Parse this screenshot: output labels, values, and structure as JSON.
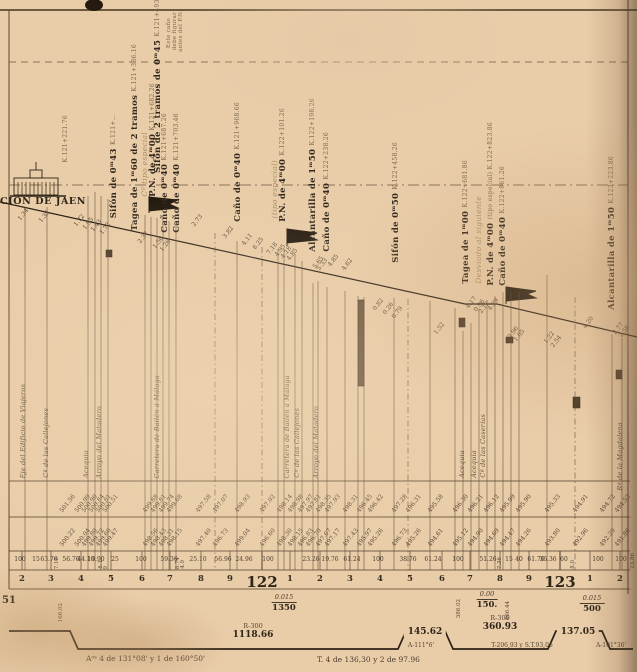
{
  "station": {
    "name": "CIÓN DE JAEN",
    "axis_km": "K.121+221.76"
  },
  "structures": [
    {
      "main": "",
      "km": "K.121+221.76",
      "x": 62,
      "b": 162
    },
    {
      "main": "Sifón de 0ᵐ43",
      "km": "K.121+…",
      "x": 110,
      "b": 218
    },
    {
      "main": "Tagea de 1ᵐ60 de 2 tramos",
      "km": "K.121+336.16",
      "x": 131,
      "b": 231
    },
    {
      "main": "Sifón de 2 tramos de 0ᵐ45",
      "km": "K.121+493.86",
      "x": 154,
      "b": 173
    },
    {
      "main": "Cº tipo especial",
      "x": 141,
      "b": 197,
      "style": "faint"
    },
    {
      "main": "P.N. de 4ᵐ00",
      "km": "K.121+682.26",
      "x": 149,
      "b": 197
    },
    {
      "main": "Caño de 0ᵐ40",
      "km": "K.121+687.26",
      "x": 161,
      "b": 233
    },
    {
      "main": "Caño de 0ᵐ40",
      "km": "K.121+703.46",
      "x": 173,
      "b": 233
    },
    {
      "main": "Este caño",
      "x": 165,
      "b": 48,
      "style": "tiny"
    },
    {
      "main": "debe figurar",
      "x": 171,
      "b": 50,
      "style": "tiny"
    },
    {
      "main": "antes del P.N.",
      "x": 177,
      "b": 52,
      "style": "tiny"
    },
    {
      "main": "Caño de 0ᵐ40",
      "km": "K.121+968.66",
      "x": 234,
      "b": 222
    },
    {
      "main": "(tipo especial)",
      "x": 271,
      "b": 218,
      "style": "faint"
    },
    {
      "main": "P.N. de 4ᵐ00",
      "km": "K.122+101.26",
      "x": 279,
      "b": 222
    },
    {
      "main": "Alcantarilla de 1ᵐ50",
      "km": "K.122+198.26",
      "x": 309,
      "b": 252
    },
    {
      "main": "Caño de 0ᵐ40",
      "km": "K.122+238.26",
      "x": 323,
      "b": 252
    },
    {
      "main": "Sifón de 0ᵐ50",
      "km": "K.122+458.26",
      "x": 392,
      "b": 263
    },
    {
      "main": "Tagea de 1ᵐ00",
      "km": "K.122+681.86",
      "x": 462,
      "b": 284
    },
    {
      "main": "Desviado al siguiente",
      "x": 475,
      "b": 284,
      "style": "faint"
    },
    {
      "main": "P.N. de 4ᵐ00",
      "km": "(tipo especial) K.122+823.86",
      "x": 487,
      "b": 286
    },
    {
      "main": "Caño de 0ᵐ40",
      "km": "K.122+861.26",
      "x": 499,
      "b": 286
    },
    {
      "main": "Alcantarilla de 1ᵐ50",
      "km": "K.123+223.86",
      "x": 608,
      "b": 310
    }
  ],
  "features": [
    {
      "t": "Eje del Edificio de Viajeros",
      "x": 24,
      "b": 478
    },
    {
      "t": "Cª de las Callejones",
      "x": 47,
      "b": 478
    },
    {
      "t": "Acequia",
      "x": 87,
      "b": 478
    },
    {
      "t": "Arroyo del Matadero",
      "x": 100,
      "b": 478
    },
    {
      "t": "Carretera de Bailén á Málaga",
      "x": 158,
      "b": 478
    },
    {
      "t": "Carretera de Bailén á Málaga",
      "x": 288,
      "b": 478
    },
    {
      "t": "Cº de las Callejones",
      "x": 298,
      "b": 478
    },
    {
      "t": "Arroyo del Matadero",
      "x": 317,
      "b": 478
    },
    {
      "t": "Acequia",
      "x": 463,
      "b": 478
    },
    {
      "t": "Acequia",
      "x": 475,
      "b": 478
    },
    {
      "t": "Cª de las Caserías",
      "x": 484,
      "b": 478
    },
    {
      "t": "Rª de la Magdalena",
      "x": 621,
      "b": 490
    }
  ],
  "profile_heights": [
    {
      "v": "1.34",
      "x": 22,
      "y": 222
    },
    {
      "v": "1.35",
      "x": 43,
      "y": 224
    },
    {
      "v": "1.72",
      "x": 78,
      "y": 228
    },
    {
      "v": "1.95",
      "x": 87,
      "y": 231
    },
    {
      "v": "1.43",
      "x": 95,
      "y": 233
    },
    {
      "v": "1.72",
      "x": 104,
      "y": 236
    },
    {
      "v": "2.37",
      "x": 142,
      "y": 245
    },
    {
      "v": "1.56",
      "x": 157,
      "y": 250
    },
    {
      "v": "1.26",
      "x": 164,
      "y": 253
    },
    {
      "v": "2.73",
      "x": 196,
      "y": 228
    },
    {
      "v": "3.82",
      "x": 227,
      "y": 240
    },
    {
      "v": "4.11",
      "x": 246,
      "y": 247
    },
    {
      "v": "6.25",
      "x": 257,
      "y": 251
    },
    {
      "v": "7.18",
      "x": 271,
      "y": 256
    },
    {
      "v": "4.95",
      "x": 279,
      "y": 258
    },
    {
      "v": "4.18",
      "x": 285,
      "y": 260
    },
    {
      "v": "4.85",
      "x": 291,
      "y": 262
    },
    {
      "v": "5.65",
      "x": 317,
      "y": 270
    },
    {
      "v": "5.33",
      "x": 321,
      "y": 272
    },
    {
      "v": "4.85",
      "x": 332,
      "y": 268
    },
    {
      "v": "4.62",
      "x": 346,
      "y": 272
    },
    {
      "v": "0.82",
      "x": 377,
      "y": 312
    },
    {
      "v": "0.26",
      "x": 387,
      "y": 316
    },
    {
      "v": "0.79",
      "x": 396,
      "y": 320
    },
    {
      "v": "1.52",
      "x": 438,
      "y": 336
    },
    {
      "v": "4.17",
      "x": 470,
      "y": 310
    },
    {
      "v": "0.96",
      "x": 478,
      "y": 313
    },
    {
      "v": "2.12",
      "x": 483,
      "y": 315
    },
    {
      "v": "4.29",
      "x": 492,
      "y": 312
    },
    {
      "v": "2.96",
      "x": 512,
      "y": 340
    },
    {
      "v": "1.65",
      "x": 518,
      "y": 343
    },
    {
      "v": "1.22",
      "x": 548,
      "y": 345
    },
    {
      "v": "2.54",
      "x": 555,
      "y": 349
    },
    {
      "v": "4.20",
      "x": 587,
      "y": 330
    },
    {
      "v": "2.77",
      "x": 617,
      "y": 336
    },
    {
      "v": "2.58",
      "x": 623,
      "y": 339
    }
  ],
  "table": {
    "rasante_row": [
      {
        "v": "501.56",
        "x": 64
      },
      {
        "v": "500.99",
        "x": 79
      },
      {
        "v": "500.90",
        "x": 86
      },
      {
        "v": "500.84",
        "x": 93
      },
      {
        "v": "500.81",
        "x": 100
      },
      {
        "v": "500.51",
        "x": 107
      },
      {
        "v": "499.88",
        "x": 147
      },
      {
        "v": "499.81",
        "x": 155
      },
      {
        "v": "499.74",
        "x": 163
      },
      {
        "v": "499.68",
        "x": 171
      },
      {
        "v": "497.58",
        "x": 200
      },
      {
        "v": "497.07",
        "x": 217
      },
      {
        "v": "498.93",
        "x": 239
      },
      {
        "v": "497.02",
        "x": 264
      },
      {
        "v": "498.14",
        "x": 281
      },
      {
        "v": "498.98",
        "x": 292
      },
      {
        "v": "497.97",
        "x": 302
      },
      {
        "v": "497.81",
        "x": 310
      },
      {
        "v": "498.35",
        "x": 320
      },
      {
        "v": "497.93",
        "x": 329
      },
      {
        "v": "498.31",
        "x": 347
      },
      {
        "v": "496.45",
        "x": 361
      },
      {
        "v": "496.42",
        "x": 372
      },
      {
        "v": "497.28",
        "x": 396
      },
      {
        "v": "496.31",
        "x": 410
      },
      {
        "v": "495.58",
        "x": 432
      },
      {
        "v": "496.30",
        "x": 457
      },
      {
        "v": "496.21",
        "x": 472
      },
      {
        "v": "496.12",
        "x": 488
      },
      {
        "v": "495.99",
        "x": 504
      },
      {
        "v": "495.90",
        "x": 520
      },
      {
        "v": "495.33",
        "x": 549
      },
      {
        "v": "494.91",
        "x": 577
      },
      {
        "v": "494.72",
        "x": 604
      },
      {
        "v": "494.52",
        "x": 619
      }
    ],
    "terreno_row": [
      {
        "v": "500.22",
        "x": 64
      },
      {
        "v": "500.04",
        "x": 79
      },
      {
        "v": "499.80",
        "x": 86
      },
      {
        "v": "499.72",
        "x": 93
      },
      {
        "v": "499.60",
        "x": 100
      },
      {
        "v": "499.47",
        "x": 107
      },
      {
        "v": "498.56",
        "x": 147
      },
      {
        "v": "498.43",
        "x": 155
      },
      {
        "v": "498.31",
        "x": 163
      },
      {
        "v": "498.15",
        "x": 171
      },
      {
        "v": "497.40",
        "x": 200
      },
      {
        "v": "496.73",
        "x": 217
      },
      {
        "v": "499.04",
        "x": 239
      },
      {
        "v": "496.60",
        "x": 264
      },
      {
        "v": "498.30",
        "x": 281
      },
      {
        "v": "498.15",
        "x": 292
      },
      {
        "v": "496.83",
        "x": 302
      },
      {
        "v": "496.70",
        "x": 310
      },
      {
        "v": "497.67",
        "x": 320
      },
      {
        "v": "497.17",
        "x": 329
      },
      {
        "v": "497.43",
        "x": 347
      },
      {
        "v": "495.97",
        "x": 361
      },
      {
        "v": "495.26",
        "x": 372
      },
      {
        "v": "496.73",
        "x": 396
      },
      {
        "v": "495.26",
        "x": 410
      },
      {
        "v": "494.61",
        "x": 432
      },
      {
        "v": "495.12",
        "x": 457
      },
      {
        "v": "494.90",
        "x": 472
      },
      {
        "v": "494.69",
        "x": 488
      },
      {
        "v": "494.47",
        "x": 504
      },
      {
        "v": "494.26",
        "x": 520
      },
      {
        "v": "493.80",
        "x": 549
      },
      {
        "v": "492.96",
        "x": 577
      },
      {
        "v": "492.20",
        "x": 604
      },
      {
        "v": "491.86",
        "x": 619
      }
    ],
    "distances_row": [
      {
        "v": "100",
        "x": 20
      },
      {
        "v": "15",
        "x": 36
      },
      {
        "v": "63.76",
        "x": 49
      },
      {
        "v": "7.18",
        "x": 58,
        "vert": 1
      },
      {
        "v": "56.76",
        "x": 71
      },
      {
        "v": "44.10",
        "x": 86
      },
      {
        "v": "19.90",
        "x": 96
      },
      {
        "v": "8.1",
        "x": 102,
        "vert": 1
      },
      {
        "v": "9",
        "x": 107,
        "vert": 1
      },
      {
        "v": "25",
        "x": 115
      },
      {
        "v": "100",
        "x": 141
      },
      {
        "v": "59.36",
        "x": 169
      },
      {
        "v": "8.74",
        "x": 179,
        "vert": 1
      },
      {
        "v": "4.9",
        "x": 184,
        "vert": 1
      },
      {
        "v": "25.10",
        "x": 198
      },
      {
        "v": "56.96",
        "x": 223
      },
      {
        "v": "24.96",
        "x": 244
      },
      {
        "v": "100",
        "x": 268
      },
      {
        "v": "23.26",
        "x": 311
      },
      {
        "v": "19.76",
        "x": 330
      },
      {
        "v": "61.24",
        "x": 352
      },
      {
        "v": "100",
        "x": 378
      },
      {
        "v": "38.76",
        "x": 408
      },
      {
        "v": "61.24",
        "x": 433
      },
      {
        "v": "100",
        "x": 458
      },
      {
        "v": "51.26",
        "x": 488
      },
      {
        "v": "7.36",
        "x": 501,
        "vert": 1
      },
      {
        "v": "15",
        "x": 509
      },
      {
        "v": "40",
        "x": 519
      },
      {
        "v": "61.76",
        "x": 536
      },
      {
        "v": "36.36",
        "x": 548
      },
      {
        "v": "60",
        "x": 564
      },
      {
        "v": "8.0",
        "x": 574,
        "vert": 1
      },
      {
        "v": "100",
        "x": 598
      },
      {
        "v": "100",
        "x": 621
      },
      {
        "v": "23.86",
        "x": 634,
        "vert": 1
      }
    ]
  },
  "hectometers": [
    {
      "n": "2",
      "x": 22
    },
    {
      "n": "3",
      "x": 51
    },
    {
      "n": "4",
      "x": 81
    },
    {
      "n": "5",
      "x": 111
    },
    {
      "n": "6",
      "x": 142
    },
    {
      "n": "7",
      "x": 170
    },
    {
      "n": "8",
      "x": 201
    },
    {
      "n": "9",
      "x": 230
    },
    {
      "n": "1",
      "x": 290
    },
    {
      "n": "2",
      "x": 320
    },
    {
      "n": "3",
      "x": 350
    },
    {
      "n": "4",
      "x": 380
    },
    {
      "n": "5",
      "x": 410
    },
    {
      "n": "6",
      "x": 442
    },
    {
      "n": "7",
      "x": 470
    },
    {
      "n": "8",
      "x": 500
    },
    {
      "n": "9",
      "x": 529
    },
    {
      "n": "1",
      "x": 590
    },
    {
      "n": "2",
      "x": 620
    }
  ],
  "kilometers": [
    {
      "n": "122",
      "x": 262,
      "y": 577
    },
    {
      "n": "123",
      "x": 560,
      "y": 577
    }
  ],
  "gradients": [
    {
      "slope": "0.015",
      "length": "1350",
      "x": 284,
      "y": 594
    },
    {
      "slope": "0.00",
      "length": "150.",
      "x": 487,
      "y": 591
    },
    {
      "slope": "0.015",
      "length": "500",
      "x": 592,
      "y": 595
    }
  ],
  "vertical_numbers": [
    {
      "v": "166.02",
      "x": 62,
      "y": 622
    },
    {
      "v": "386.02",
      "x": 460,
      "y": 618
    },
    {
      "v": "466.44",
      "x": 509,
      "y": 620
    }
  ],
  "alignment": {
    "segments": [
      {
        "r": "R-300",
        "v": "1118.66",
        "x": 253,
        "y": 631
      },
      {
        "v": "145.62",
        "x": 425,
        "y": 632,
        "box": 1
      },
      {
        "r": "R-300",
        "v": "360.93",
        "x": 500,
        "y": 623
      },
      {
        "v": "137.05",
        "x": 578,
        "y": 632,
        "box": 1
      }
    ],
    "subs": [
      {
        "t": "T-206,93 y S.T.93,06",
        "x": 522,
        "y": 643
      }
    ],
    "angles": [
      {
        "t": "A-111°6'",
        "x": 421,
        "y": 643
      },
      {
        "t": "A-101°36'",
        "x": 611,
        "y": 643
      }
    ],
    "fragment": "51"
  },
  "footer": {
    "left": "Aᵒˢ 4 de 131°08' y 1 de 160°50'",
    "mid": "T. 4 de 136,30 y 2 de 97.96"
  },
  "grid_lines": [
    {
      "x": 25,
      "y1": 207
    },
    {
      "x": 47,
      "y1": 207
    },
    {
      "x": 88,
      "y1": 196
    },
    {
      "x": 95,
      "y1": 192
    },
    {
      "x": 101,
      "y1": 196
    },
    {
      "x": 108,
      "y1": 199
    },
    {
      "x": 145,
      "y1": 215
    },
    {
      "x": 151,
      "y1": 217
    },
    {
      "x": 157,
      "y1": 218
    },
    {
      "x": 163,
      "y1": 220
    },
    {
      "x": 169,
      "y1": 221
    },
    {
      "x": 176,
      "y1": 223
    },
    {
      "x": 215,
      "y1": 233,
      "d": 1
    },
    {
      "x": 237,
      "y1": 241
    },
    {
      "x": 262,
      "y1": 247,
      "d": 1
    },
    {
      "x": 278,
      "y1": 249
    },
    {
      "x": 284,
      "y1": 249
    },
    {
      "x": 295,
      "y1": 254
    },
    {
      "x": 302,
      "y1": 261
    },
    {
      "x": 313,
      "y1": 283
    },
    {
      "x": 318,
      "y1": 281
    },
    {
      "x": 327,
      "y1": 287
    },
    {
      "x": 345,
      "y1": 291
    },
    {
      "x": 358,
      "y1": 296
    },
    {
      "x": 364,
      "y1": 297
    },
    {
      "x": 394,
      "y1": 298
    },
    {
      "x": 408,
      "y1": 299,
      "d": 1
    },
    {
      "x": 430,
      "y1": 301
    },
    {
      "x": 455,
      "y1": 308
    },
    {
      "x": 463,
      "y1": 331
    },
    {
      "x": 471,
      "y1": 323
    },
    {
      "x": 479,
      "y1": 309
    },
    {
      "x": 487,
      "y1": 300
    },
    {
      "x": 495,
      "y1": 296
    },
    {
      "x": 503,
      "y1": 292
    },
    {
      "x": 511,
      "y1": 293
    },
    {
      "x": 519,
      "y1": 292
    },
    {
      "x": 547,
      "y1": 275
    },
    {
      "x": 575,
      "y1": 297,
      "d": 1
    },
    {
      "x": 612,
      "y1": 334
    },
    {
      "x": 622,
      "y1": 338
    }
  ]
}
